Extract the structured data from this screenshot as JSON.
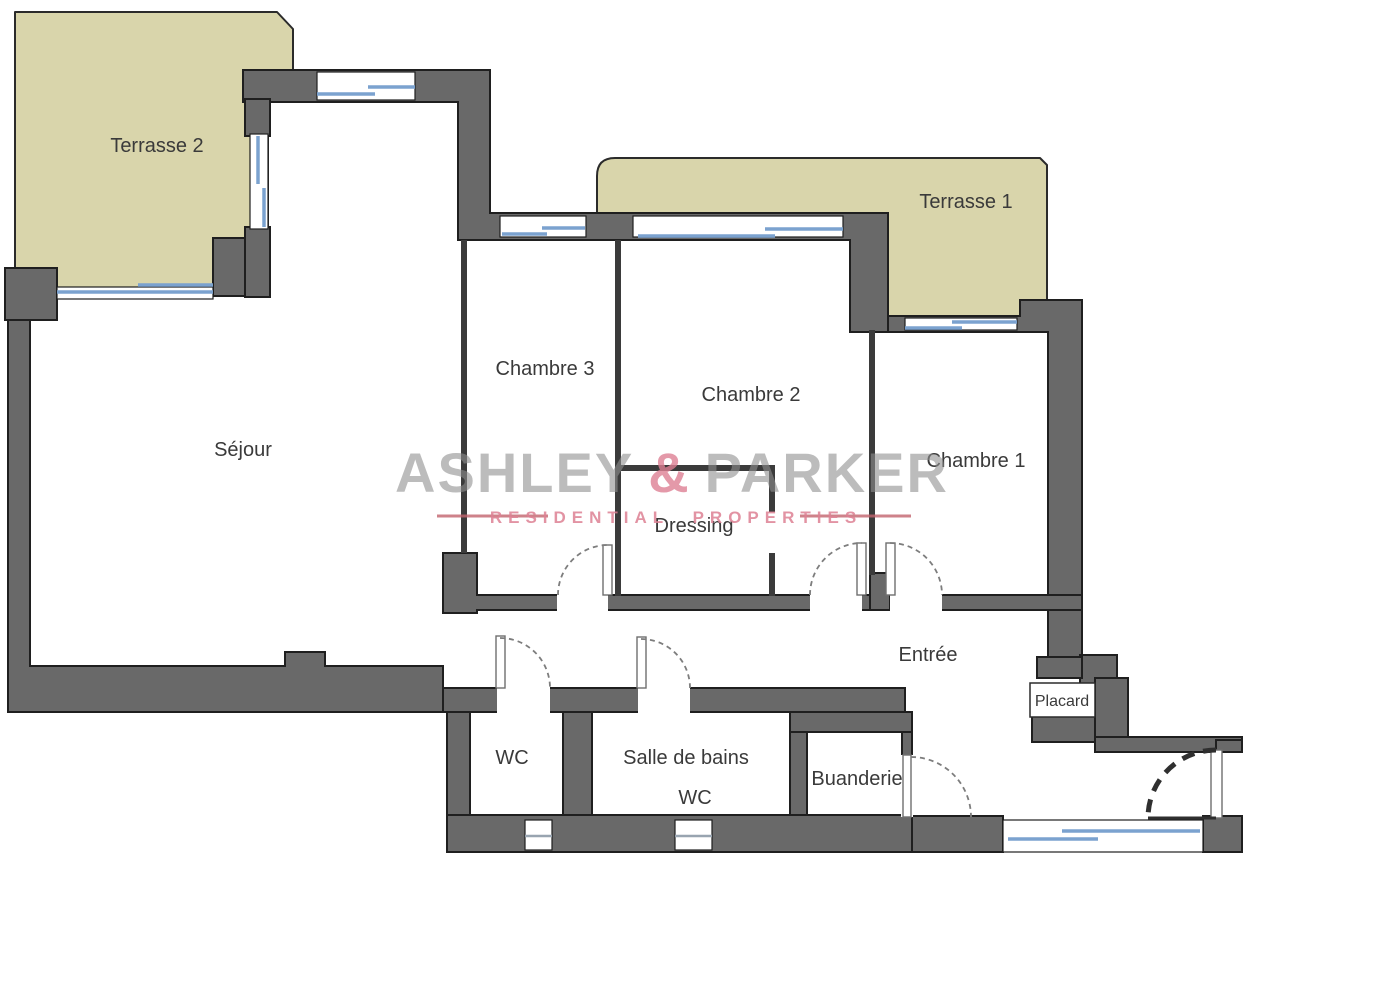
{
  "plan": {
    "rooms": {
      "terrasse2": "Terrasse 2",
      "terrasse1": "Terrasse 1",
      "sejour": "Séjour",
      "chambre3": "Chambre 3",
      "chambre2": "Chambre 2",
      "chambre1": "Chambre 1",
      "dressing": "Dressing",
      "entree": "Entrée",
      "placard": "Placard",
      "wc": "WC",
      "salle_de_bains": "Salle de bains",
      "wc_small": "WC",
      "buanderie": "Buanderie"
    },
    "colors": {
      "wall": "#696969",
      "wall_outline": "#1f1f1f",
      "terrace": "#d9d5ab",
      "window": "#7ba2cf",
      "label": "#3a3a3a"
    }
  },
  "watermark": {
    "brand_left": "ASHLEY",
    "brand_amp": "&",
    "brand_right": "PARKER",
    "tagline": "RESIDENTIAL PROPERTIES",
    "brand_color": "#8f8f8f",
    "accent_color": "#dd8093"
  }
}
